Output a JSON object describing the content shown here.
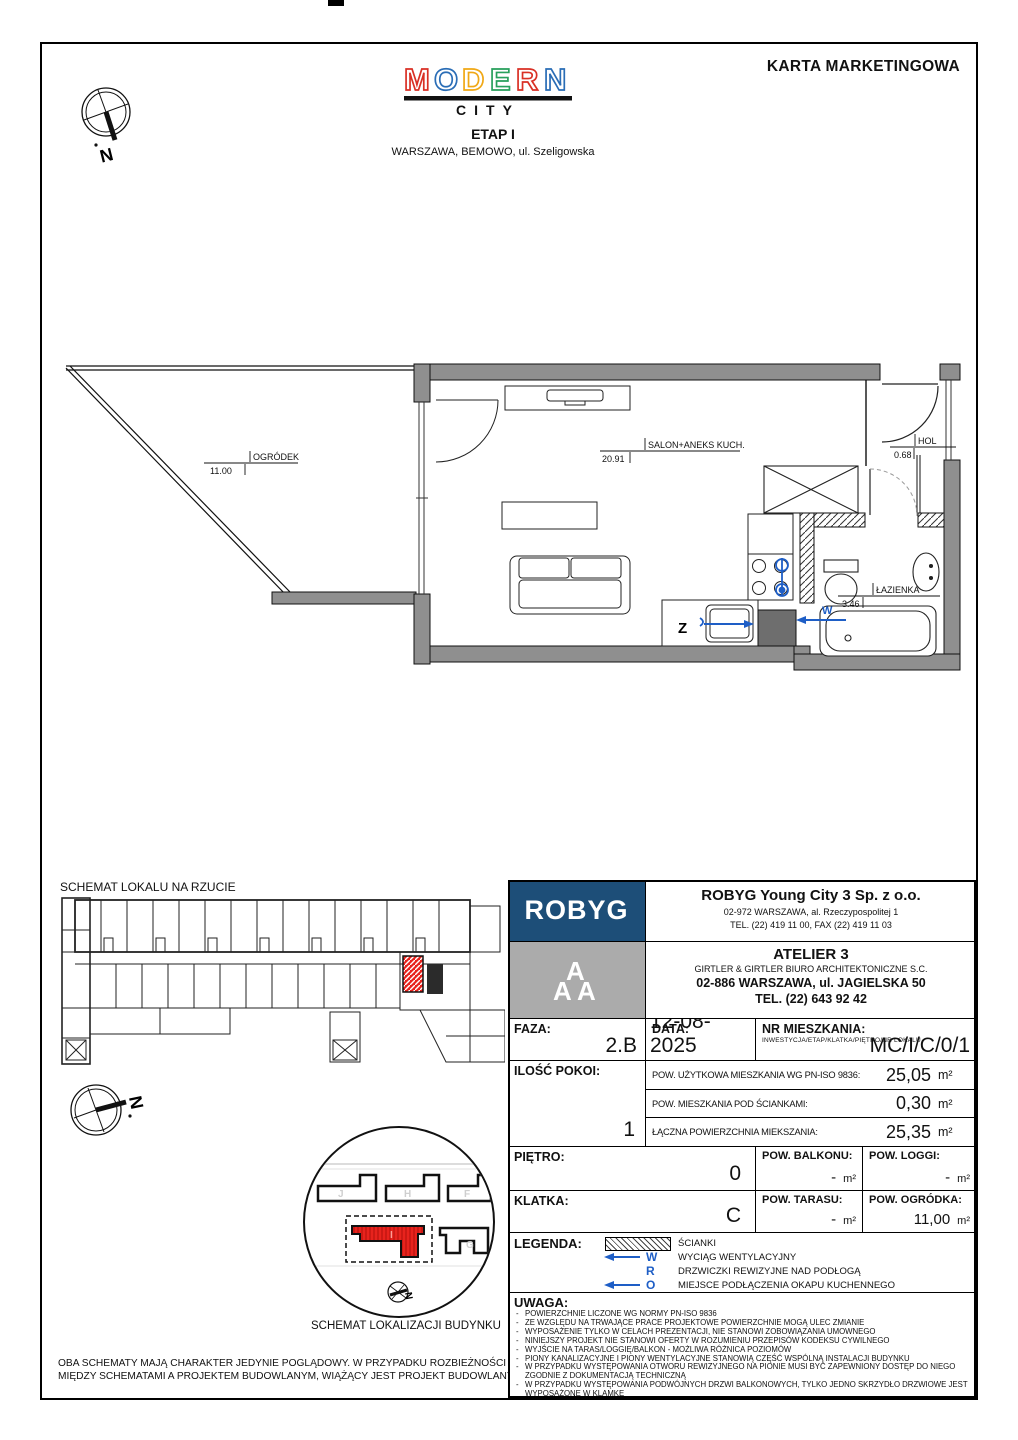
{
  "page": {
    "doc_title": "KARTA MARKETINGOWA"
  },
  "header": {
    "logo": {
      "letters": [
        {
          "ch": "M"
        },
        {
          "ch": "O"
        },
        {
          "ch": "D"
        },
        {
          "ch": "E"
        },
        {
          "ch": "R"
        },
        {
          "ch": "N"
        }
      ],
      "sub": "CITY"
    },
    "etap": "ETAP I",
    "address": "WARSZAWA, BEMOWO, ul. Szeligowska"
  },
  "plan": {
    "rooms": [
      {
        "name": "OGRÓDEK",
        "area": "11.00"
      },
      {
        "name": "SALON+ANEKS KUCH.",
        "area": "20.91"
      },
      {
        "name": "HOL",
        "area": "0.68"
      },
      {
        "name": "ŁAZIENKA",
        "area": "3.46"
      }
    ],
    "sink_label": "Z",
    "vent_label": "W"
  },
  "schematics": {
    "plan_title": "SCHEMAT LOKALU NA RZUCIE",
    "location_title": "SCHEMAT LOKALIZACJI BUDYNKU",
    "building_labels": [
      "J",
      "H",
      "F",
      "I",
      "G"
    ],
    "compass_label": "N",
    "disclaimer": "OBA SCHEMATY MAJĄ CHARAKTER JEDYNIE POGLĄDOWY. W PRZYPADKU ROZBIEŻNOŚCI MIĘDZY SCHEMATAMI A PROJEKTEM BUDOWLANYM, WIĄŻĄCY JEST PROJEKT BUDOWLANY."
  },
  "developer": {
    "logo_text": "ROBYG",
    "name": "ROBYG Young City 3 Sp. z o.o.",
    "address": "02-972 WARSZAWA, al. Rzeczypospolitej 1",
    "phone": "TEL. (22) 419 11 00, FAX (22) 419 11 03"
  },
  "architect": {
    "logo_letter": "A",
    "name": "ATELIER 3",
    "sub": "GIRTLER & GIRTLER BIURO ARCHITEKTONICZNE S.C.",
    "address": "02-886 WARSZAWA, ul. JAGIELSKA 50",
    "phone": "TEL. (22) 643 92 42"
  },
  "details": {
    "unit": "m²",
    "faza": {
      "label": "FAZA:",
      "value": "2.B"
    },
    "data": {
      "label": "DATA:",
      "value": "12-08-2025"
    },
    "nr": {
      "label": "NR MIESZKANIA:",
      "sub": "INWESTYCJA/ETAP/KLATKA/PIĘTRO/NR LOKALU",
      "value": "MC/I/C/0/1"
    },
    "pokoje": {
      "label": "ILOŚĆ POKOI:",
      "value": "1"
    },
    "areas": [
      {
        "label": "POW. UŻYTKOWA MIESZKANIA WG PN-ISO 9836:",
        "value": "25,05"
      },
      {
        "label": "POW. MIESZKANIA POD ŚCIANKAMI:",
        "value": "0,30"
      },
      {
        "label": "ŁĄCZNA POWIERZCHNIA MIEKSZANIA:",
        "value": "25,35"
      }
    ],
    "pietro": {
      "label": "PIĘTRO:",
      "value": "0"
    },
    "klatka": {
      "label": "KLATKA:",
      "value": "C"
    },
    "balkon": {
      "label": "POW. BALKONU:",
      "value": "-"
    },
    "loggia": {
      "label": "POW. LOGGI:",
      "value": "-"
    },
    "taras": {
      "label": "POW. TARASU:",
      "value": "-"
    },
    "ogrodek": {
      "label": "POW. OGRÓDKA:",
      "value": "11,00"
    }
  },
  "legend": {
    "label": "LEGENDA:",
    "items": [
      {
        "symbol": "hatch-box",
        "text": "ŚCIANKI"
      },
      {
        "symbol": "arrow-left",
        "letter": "W",
        "text": "WYCIĄG WENTYLACYJNY"
      },
      {
        "symbol": "letter-only",
        "letter": "R",
        "text": "DRZWICZKI REWIZYJNE NAD PODŁOGĄ"
      },
      {
        "symbol": "arrow-left",
        "letter": "O",
        "text": "MIEJSCE PODŁĄCZENIA OKAPU KUCHENNEGO"
      }
    ]
  },
  "uwaga": {
    "label": "UWAGA:",
    "notes": [
      "POWIERZCHNIE LICZONE WG NORMY PN-ISO 9836",
      "ZE WZGLĘDU NA TRWAJĄCE PRACE PROJEKTOWE POWIERZCHNIE MOGĄ ULEC ZMIANIE",
      "WYPOSAŻENIE TYLKO W CELACH PREZENTACJI, NIE STANOWI ZOBOWIĄZANIA UMOWNEGO",
      "NINIEJSZY PROJEKT NIE STANOWI OFERTY W ROZUMIENIU PRZEPISÓW KODEKSU CYWILNEGO",
      "WYJŚCIE NA TARAS/LOGGIĘ/BALKON - MOŻLIWA RÓŻNICA POZIOMÓW",
      "PIONY KANALIZACYJNE I PIONY WENTYLACYJNE STANOWIĄ CZĘŚĆ WSPÓLNĄ INSTALACJI BUDYNKU",
      "W PRZYPADKU WYSTĘPOWANIA OTWORU REWIZYJNEGO NA PIONIE MUSI BYĆ ZAPEWNIONY DOSTĘP DO NIEGO ZGODNIE Z DOKUMENTACJĄ TECHNICZNĄ",
      "W PRZYPADKU WYSTĘPOWANIA PODWÓJNYCH DRZWI BALKONOWYCH, TYLKO JEDNO SKRZYDŁO DRZWIOWE JEST WYPOSAŻONE W KLAMKĘ"
    ]
  },
  "colors": {
    "robyg_navy": "#1d4e78",
    "atelier_gray": "#ababab",
    "highlight_red": "#e8231d",
    "symbol_blue": "#1e5ec6",
    "wall_gray": "#8f8f8f",
    "logo_red": "#d93025",
    "logo_blue": "#2a6db6",
    "logo_yellow": "#f0a816",
    "logo_green": "#28a05c"
  }
}
